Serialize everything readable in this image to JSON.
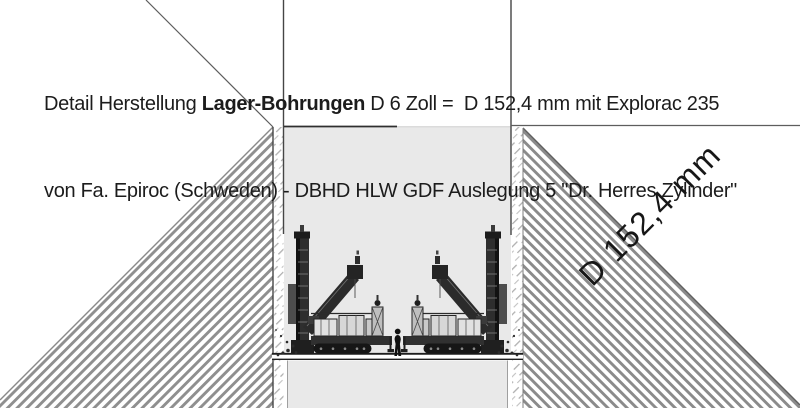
{
  "title": {
    "line1_prefix": "Detail Herstellung ",
    "line1_bold": "Lager-Bohrungen",
    "line1_suffix": " D 6 Zoll =  D 152,4 mm mit Explorac 235",
    "line2": "von Fa. Epiroc (Schweden) - DBHD HLW GDF Auslegung 5 \"Dr. Herres Zylinder\""
  },
  "drawing": {
    "diameter_label": "D 152,4 mm",
    "colors": {
      "background": "#ffffff",
      "shaft_fill": "#e9e9e9",
      "rock_hatch": "#8f8f8f",
      "linework": "#454545",
      "text": "#1c1c1c"
    }
  }
}
